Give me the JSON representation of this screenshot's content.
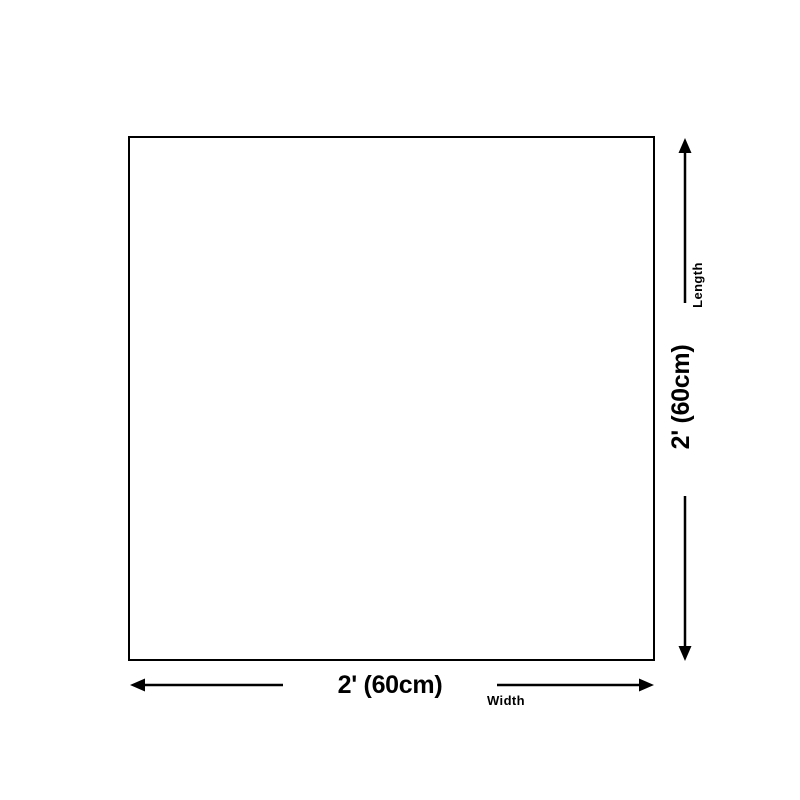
{
  "theme": {
    "background": "#ffffff",
    "line_color": "#000000"
  },
  "diagram": {
    "title": "product-size-diagram",
    "length": {
      "label": "Length",
      "value": "2' (60cm)"
    },
    "width": {
      "label": "Width",
      "value": "2' (60cm)"
    }
  }
}
